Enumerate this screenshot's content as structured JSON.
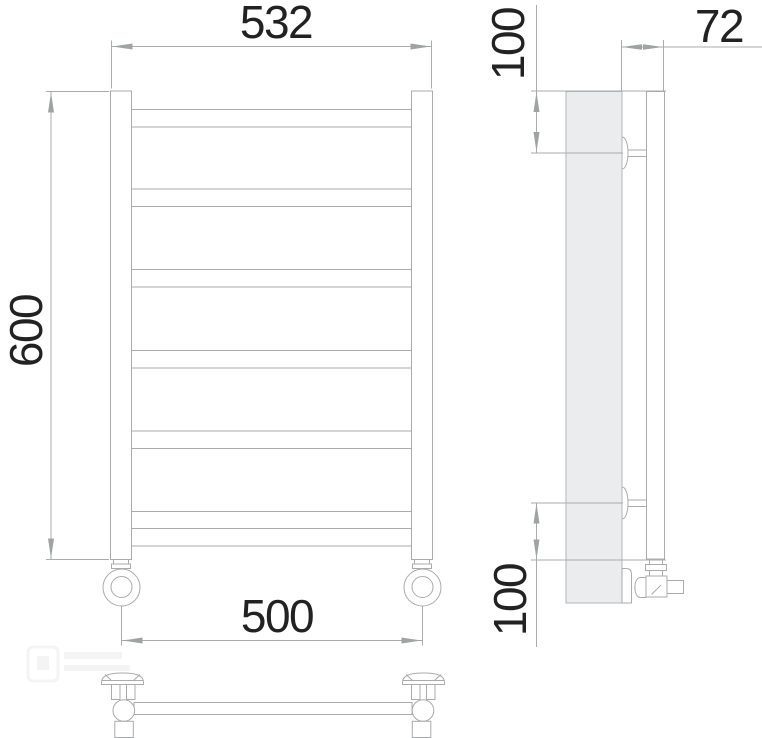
{
  "dimensions": {
    "overall_width": "532",
    "overall_height": "600",
    "connection_spacing": "500",
    "depth": "72",
    "top_mount_offset": "100",
    "bottom_mount_offset": "100"
  },
  "colors": {
    "line": "#a9abac",
    "dimension_text": "#222222",
    "wall_fill": "#ebeced",
    "background": "#ffffff"
  }
}
